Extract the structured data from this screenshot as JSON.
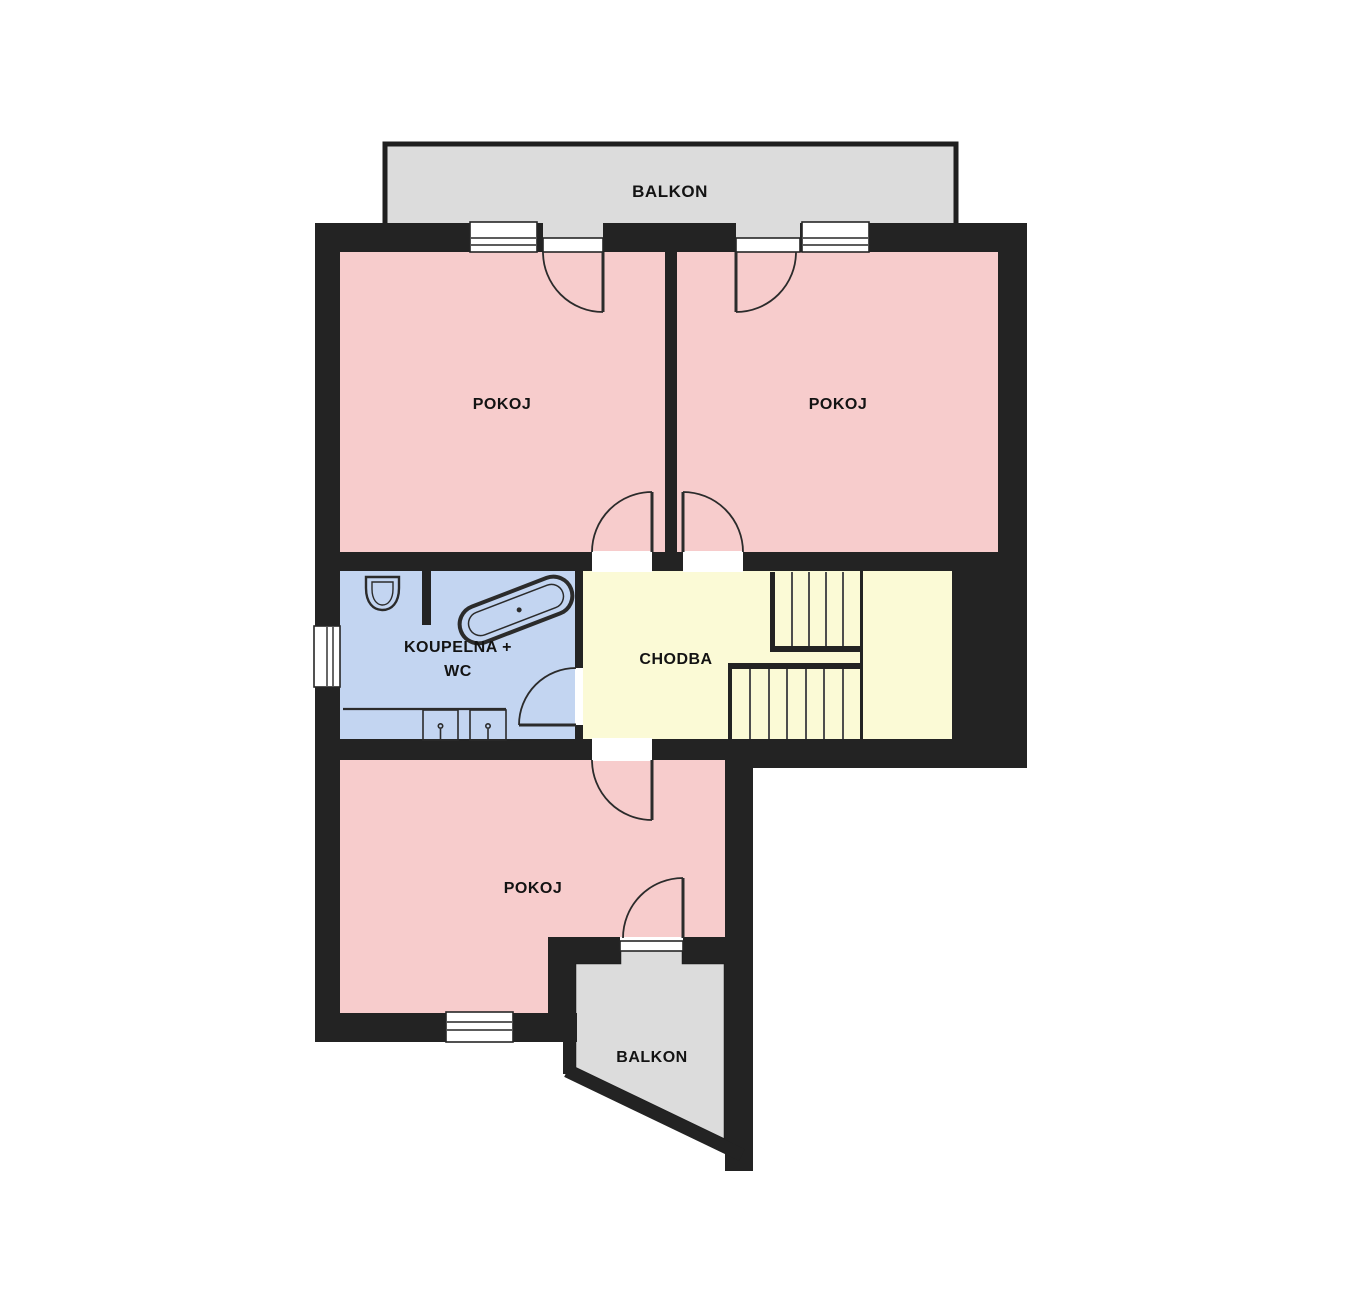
{
  "plan": {
    "title": "Floor plan",
    "colors": {
      "wall": "#232323",
      "room": "#f7cccc",
      "bathroom": "#c3d5f1",
      "hallway": "#fbfad6",
      "balcony": "#dcdcdc",
      "label": "#131313"
    },
    "labels": {
      "balcony_top": "BALKON",
      "room_top_left": "POKOJ",
      "room_top_right": "POKOJ",
      "bathroom_line1": "KOUPELNA +",
      "bathroom_line2": "WC",
      "hallway": "CHODBA",
      "room_bottom": "POKOJ",
      "balcony_bottom": "BALKON"
    }
  }
}
